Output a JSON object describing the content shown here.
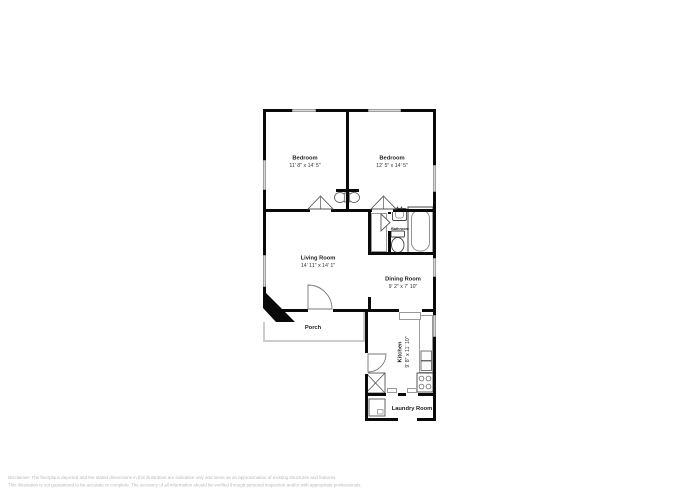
{
  "plan": {
    "rooms": {
      "bedroom1": {
        "name": "Bedroom",
        "dims": "11' 8\" x 14' 5\""
      },
      "bedroom2": {
        "name": "Bedroom",
        "dims": "12' 5\" x 14' 5\""
      },
      "living_room": {
        "name": "Living Room",
        "dims": "14' 11\" x 14' 1\""
      },
      "dining_room": {
        "name": "Dining Room",
        "dims": "9' 2\" x 7' 10\""
      },
      "kitchen": {
        "name": "Kitchen",
        "dims": "9' 8\" x 11' 10\""
      },
      "bathroom": {
        "name": "Bathroom"
      },
      "laundry_room": {
        "name": "Laundry Room"
      },
      "porch": {
        "name": "Porch"
      },
      "fireplace": {
        "name": "Fireplace"
      }
    },
    "colors": {
      "wall": "#0a0a0a",
      "window_fill": "#d8d8d8",
      "fixture_line": "#555555",
      "label_text": "#1c1c1c",
      "disclaimer_text": "#b9b9b9"
    }
  },
  "footer": {
    "disclaimer_line1": "Disclaimer: The floorplans depicted and the stated dimensions in this illustration are indicative only and serve as an approximation of existing structures and features.",
    "disclaimer_line2": "This illustration is not guaranteed to be accurate or complete. The accuracy of all information should be verified through personal inspection and/or with appropriate professionals."
  }
}
